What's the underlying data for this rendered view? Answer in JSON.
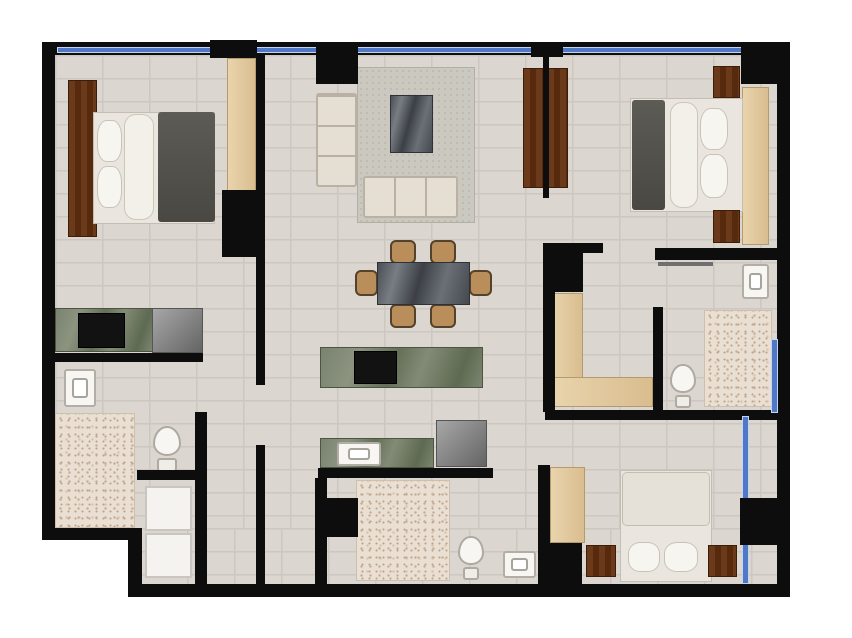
{
  "title": "apartment-floor-plan",
  "canvas": {
    "width": 852,
    "height": 638,
    "bg": "#ffffff"
  },
  "palette": {
    "bg": "#ffffff",
    "wall": "#0d0d0d",
    "window": "#4f79c6",
    "floor": "#dbd6d0",
    "grout": "#cdc7c0",
    "speckle": "#eadfd3",
    "rug": "#cbc8bf",
    "wood": "#6a3a1b",
    "tan": "#e9d4ad",
    "marbleGreen": "#79836f",
    "marbleDark": "#4b4f55",
    "chair": "#b98e5b"
  },
  "plan": {
    "elements": [
      {
        "n": "floor-main-upper",
        "t": "floor",
        "x": 55,
        "y": 55,
        "w": 722,
        "h": 473
      },
      {
        "n": "floor-main-lower",
        "t": "floor",
        "x": 140,
        "y": 528,
        "w": 637,
        "h": 56
      },
      {
        "n": "bathroom1-speckle-floor",
        "t": "speckle",
        "x": 55,
        "y": 413,
        "w": 80,
        "h": 115
      },
      {
        "n": "bathroom2-speckle-floor",
        "t": "speckle",
        "x": 356,
        "y": 480,
        "w": 94,
        "h": 101
      },
      {
        "n": "bathroom3-speckle-floor",
        "t": "speckle",
        "x": 704,
        "y": 310,
        "w": 68,
        "h": 97
      },
      {
        "n": "living-room-rug",
        "t": "rug",
        "x": 357,
        "y": 67,
        "w": 118,
        "h": 156
      },
      {
        "n": "bedroom1-headboard",
        "t": "wood",
        "x": 68,
        "y": 80,
        "w": 29,
        "h": 157
      },
      {
        "n": "bedroom1-bed-sheet",
        "t": "bed-sheet",
        "x": 93,
        "y": 112,
        "w": 122,
        "h": 112
      },
      {
        "n": "bedroom1-blanket",
        "t": "blanket",
        "x": 158,
        "y": 112,
        "w": 57,
        "h": 110
      },
      {
        "n": "bedroom1-bolster",
        "t": "bolster",
        "x": 124,
        "y": 114,
        "w": 30,
        "h": 106
      },
      {
        "n": "bedroom1-pillow-1",
        "t": "pillow",
        "x": 97,
        "y": 120,
        "w": 25,
        "h": 42
      },
      {
        "n": "bedroom1-pillow-2",
        "t": "pillow",
        "x": 97,
        "y": 166,
        "w": 25,
        "h": 42
      },
      {
        "n": "bedroom1-wardrobe",
        "t": "tan",
        "x": 227,
        "y": 58,
        "w": 29,
        "h": 133
      },
      {
        "n": "kitchenette-counter",
        "t": "marble-green",
        "x": 55,
        "y": 308,
        "w": 98,
        "h": 44
      },
      {
        "n": "kitchenette-cooktop",
        "t": "cooktop",
        "x": 78,
        "y": 313,
        "w": 47,
        "h": 35
      },
      {
        "n": "kitchenette-fridge",
        "t": "appliance",
        "x": 152,
        "y": 308,
        "w": 51,
        "h": 45
      },
      {
        "n": "bathroom1-sink",
        "t": "sink",
        "x": 64,
        "y": 369,
        "w": 32,
        "h": 38
      },
      {
        "n": "bathroom1-toilet",
        "t": "toilet",
        "x": 150,
        "y": 426,
        "w": 34,
        "h": 46
      },
      {
        "n": "laundry-washer",
        "t": "white-goods",
        "x": 145,
        "y": 486,
        "w": 47,
        "h": 45
      },
      {
        "n": "laundry-dryer",
        "t": "white-goods",
        "x": 145,
        "y": 533,
        "w": 47,
        "h": 45
      },
      {
        "n": "living-sofa-left",
        "t": "sofa sofa-v",
        "x": 316,
        "y": 93,
        "w": 41,
        "h": 94
      },
      {
        "n": "living-sofa-bottom",
        "t": "sofa sofa-h",
        "x": 363,
        "y": 176,
        "w": 95,
        "h": 42
      },
      {
        "n": "living-coffee-table",
        "t": "marble-dark",
        "x": 390,
        "y": 95,
        "w": 43,
        "h": 58
      },
      {
        "n": "dining-chair-top-left",
        "t": "chair",
        "x": 390,
        "y": 240,
        "w": 26,
        "h": 24
      },
      {
        "n": "dining-chair-top-right",
        "t": "chair",
        "x": 430,
        "y": 240,
        "w": 26,
        "h": 24
      },
      {
        "n": "dining-chair-bottom-left",
        "t": "chair",
        "x": 390,
        "y": 304,
        "w": 26,
        "h": 24
      },
      {
        "n": "dining-chair-bottom-right",
        "t": "chair",
        "x": 430,
        "y": 304,
        "w": 26,
        "h": 24
      },
      {
        "n": "dining-chair-left",
        "t": "chair",
        "x": 355,
        "y": 270,
        "w": 23,
        "h": 26
      },
      {
        "n": "dining-chair-right",
        "t": "chair",
        "x": 469,
        "y": 270,
        "w": 23,
        "h": 26
      },
      {
        "n": "dining-table",
        "t": "marble-dark",
        "x": 377,
        "y": 262,
        "w": 93,
        "h": 43
      },
      {
        "n": "kitchen-island",
        "t": "marble-green",
        "x": 320,
        "y": 347,
        "w": 163,
        "h": 41
      },
      {
        "n": "kitchen-island-cooktop",
        "t": "cooktop",
        "x": 354,
        "y": 351,
        "w": 43,
        "h": 33
      },
      {
        "n": "kitchen-counter",
        "t": "marble-green",
        "x": 320,
        "y": 438,
        "w": 114,
        "h": 30
      },
      {
        "n": "kitchen-sink",
        "t": "sink",
        "x": 337,
        "y": 442,
        "w": 44,
        "h": 24
      },
      {
        "n": "kitchen-fridge",
        "t": "appliance",
        "x": 436,
        "y": 420,
        "w": 51,
        "h": 47
      },
      {
        "n": "living-tv-panel",
        "t": "wood",
        "x": 523,
        "y": 68,
        "w": 45,
        "h": 120
      },
      {
        "n": "bedroom2-headboard",
        "t": "tan",
        "x": 742,
        "y": 87,
        "w": 27,
        "h": 158
      },
      {
        "n": "bedroom2-bed-sheet",
        "t": "bed-sheet",
        "x": 630,
        "y": 98,
        "w": 113,
        "h": 114
      },
      {
        "n": "bedroom2-blanket",
        "t": "blanket",
        "x": 632,
        "y": 100,
        "w": 33,
        "h": 110
      },
      {
        "n": "bedroom2-bolster",
        "t": "bolster",
        "x": 670,
        "y": 102,
        "w": 28,
        "h": 106
      },
      {
        "n": "bedroom2-pillow-1",
        "t": "pillow",
        "x": 700,
        "y": 108,
        "w": 28,
        "h": 42
      },
      {
        "n": "bedroom2-pillow-2",
        "t": "pillow",
        "x": 700,
        "y": 154,
        "w": 28,
        "h": 44
      },
      {
        "n": "bedroom2-nightstand-top",
        "t": "wood",
        "x": 713,
        "y": 66,
        "w": 27,
        "h": 32
      },
      {
        "n": "bedroom2-nightstand-bottom",
        "t": "wood",
        "x": 713,
        "y": 210,
        "w": 27,
        "h": 33
      },
      {
        "n": "walkin-closet-vertical",
        "t": "tan",
        "x": 550,
        "y": 293,
        "w": 33,
        "h": 114
      },
      {
        "n": "walkin-closet-horizontal",
        "t": "tan",
        "x": 550,
        "y": 377,
        "w": 103,
        "h": 30
      },
      {
        "n": "bathroom3-sink",
        "t": "sink",
        "x": 742,
        "y": 264,
        "w": 27,
        "h": 35
      },
      {
        "n": "bathroom3-toilet",
        "t": "toilet",
        "x": 668,
        "y": 364,
        "w": 30,
        "h": 44
      },
      {
        "n": "bedroom3-closet",
        "t": "tan",
        "x": 550,
        "y": 467,
        "w": 35,
        "h": 76
      },
      {
        "n": "bedroom3-bed-sheet",
        "t": "bed-sheet",
        "x": 620,
        "y": 470,
        "w": 92,
        "h": 112
      },
      {
        "n": "bedroom3-duvet",
        "t": "duvet",
        "x": 622,
        "y": 472,
        "w": 88,
        "h": 54
      },
      {
        "n": "bedroom3-pillow-1",
        "t": "pillow",
        "x": 628,
        "y": 542,
        "w": 32,
        "h": 30
      },
      {
        "n": "bedroom3-pillow-2",
        "t": "pillow",
        "x": 664,
        "y": 542,
        "w": 34,
        "h": 30
      },
      {
        "n": "bedroom3-nightstand-left",
        "t": "wood",
        "x": 586,
        "y": 545,
        "w": 30,
        "h": 32
      },
      {
        "n": "bedroom3-nightstand-right",
        "t": "wood",
        "x": 708,
        "y": 545,
        "w": 29,
        "h": 32
      },
      {
        "n": "bathroom2-toilet",
        "t": "toilet",
        "x": 456,
        "y": 536,
        "w": 30,
        "h": 44
      },
      {
        "n": "bathroom2-sink",
        "t": "sink",
        "x": 503,
        "y": 551,
        "w": 33,
        "h": 27
      },
      {
        "n": "wall-exterior-top",
        "t": "wall",
        "x": 42,
        "y": 42,
        "w": 748,
        "h": 13
      },
      {
        "n": "wall-exterior-left",
        "t": "wall",
        "x": 42,
        "y": 42,
        "w": 13,
        "h": 498
      },
      {
        "n": "wall-exterior-right",
        "t": "wall",
        "x": 777,
        "y": 42,
        "w": 13,
        "h": 555
      },
      {
        "n": "wall-exterior-bottom",
        "t": "wall",
        "x": 128,
        "y": 584,
        "w": 662,
        "h": 13
      },
      {
        "n": "wall-step-horizontal",
        "t": "wall",
        "x": 42,
        "y": 528,
        "w": 100,
        "h": 12
      },
      {
        "n": "wall-step-vertical",
        "t": "wall",
        "x": 128,
        "y": 528,
        "w": 14,
        "h": 69
      },
      {
        "n": "wall-bedroom1-upper",
        "t": "wall",
        "x": 256,
        "y": 55,
        "w": 9,
        "h": 330
      },
      {
        "n": "wall-bedroom1-lower",
        "t": "wall",
        "x": 256,
        "y": 445,
        "w": 9,
        "h": 139
      },
      {
        "n": "pillar-bedroom1",
        "t": "wall",
        "x": 222,
        "y": 190,
        "w": 35,
        "h": 67
      },
      {
        "n": "wall-kitchenette-edge",
        "t": "wall",
        "x": 55,
        "y": 353,
        "w": 148,
        "h": 9
      },
      {
        "n": "wall-laundry-vertical",
        "t": "wall",
        "x": 195,
        "y": 412,
        "w": 12,
        "h": 172
      },
      {
        "n": "wall-laundry-horizontal",
        "t": "wall",
        "x": 137,
        "y": 470,
        "w": 70,
        "h": 10
      },
      {
        "n": "wall-kitchen-edge",
        "t": "wall",
        "x": 318,
        "y": 468,
        "w": 175,
        "h": 10
      },
      {
        "n": "wall-bathroom2-left",
        "t": "wall",
        "x": 315,
        "y": 478,
        "w": 12,
        "h": 106
      },
      {
        "n": "pillar-bathroom2",
        "t": "wall",
        "x": 327,
        "y": 498,
        "w": 31,
        "h": 39
      },
      {
        "n": "wall-bathroom2-right",
        "t": "wall",
        "x": 538,
        "y": 465,
        "w": 12,
        "h": 119
      },
      {
        "n": "pillar-bedroom3-closet",
        "t": "wall",
        "x": 548,
        "y": 543,
        "w": 34,
        "h": 41
      },
      {
        "n": "wall-hall-horizontal",
        "t": "wall",
        "x": 545,
        "y": 410,
        "w": 235,
        "h": 10
      },
      {
        "n": "wall-closet-left",
        "t": "wall",
        "x": 543,
        "y": 245,
        "w": 12,
        "h": 167
      },
      {
        "n": "pillar-closet",
        "t": "wall",
        "x": 543,
        "y": 245,
        "w": 40,
        "h": 47
      },
      {
        "n": "wall-closet-top",
        "t": "wall",
        "x": 543,
        "y": 243,
        "w": 60,
        "h": 10
      },
      {
        "n": "wall-bedroom2-bottom",
        "t": "wall",
        "x": 655,
        "y": 248,
        "w": 122,
        "h": 12
      },
      {
        "n": "wall-closet-right",
        "t": "wall",
        "x": 653,
        "y": 307,
        "w": 10,
        "h": 110
      },
      {
        "n": "door-leaf-bathroom3",
        "t": "door-leaf",
        "x": 658,
        "y": 262,
        "w": 55,
        "h": 4
      },
      {
        "n": "window-top",
        "t": "window",
        "x": 58,
        "y": 48,
        "w": 686,
        "h": 4
      },
      {
        "n": "window-bathroom3",
        "t": "window",
        "x": 772,
        "y": 340,
        "w": 5,
        "h": 72
      },
      {
        "n": "window-bedroom3",
        "t": "window",
        "x": 743,
        "y": 417,
        "w": 5,
        "h": 166
      },
      {
        "n": "wall-top-thick-segment",
        "t": "wall",
        "x": 210,
        "y": 40,
        "w": 47,
        "h": 18
      },
      {
        "n": "pillar-top-living",
        "t": "wall",
        "x": 316,
        "y": 42,
        "w": 42,
        "h": 42
      },
      {
        "n": "pillar-top-bedroom2",
        "t": "wall",
        "x": 741,
        "y": 42,
        "w": 42,
        "h": 42
      },
      {
        "n": "wall-tv-stem",
        "t": "wall",
        "x": 543,
        "y": 47,
        "w": 6,
        "h": 151
      },
      {
        "n": "wall-tv-cap",
        "t": "wall",
        "x": 531,
        "y": 45,
        "w": 32,
        "h": 12
      },
      {
        "n": "pillar-bedroom3",
        "t": "wall",
        "x": 740,
        "y": 498,
        "w": 40,
        "h": 47
      }
    ]
  }
}
